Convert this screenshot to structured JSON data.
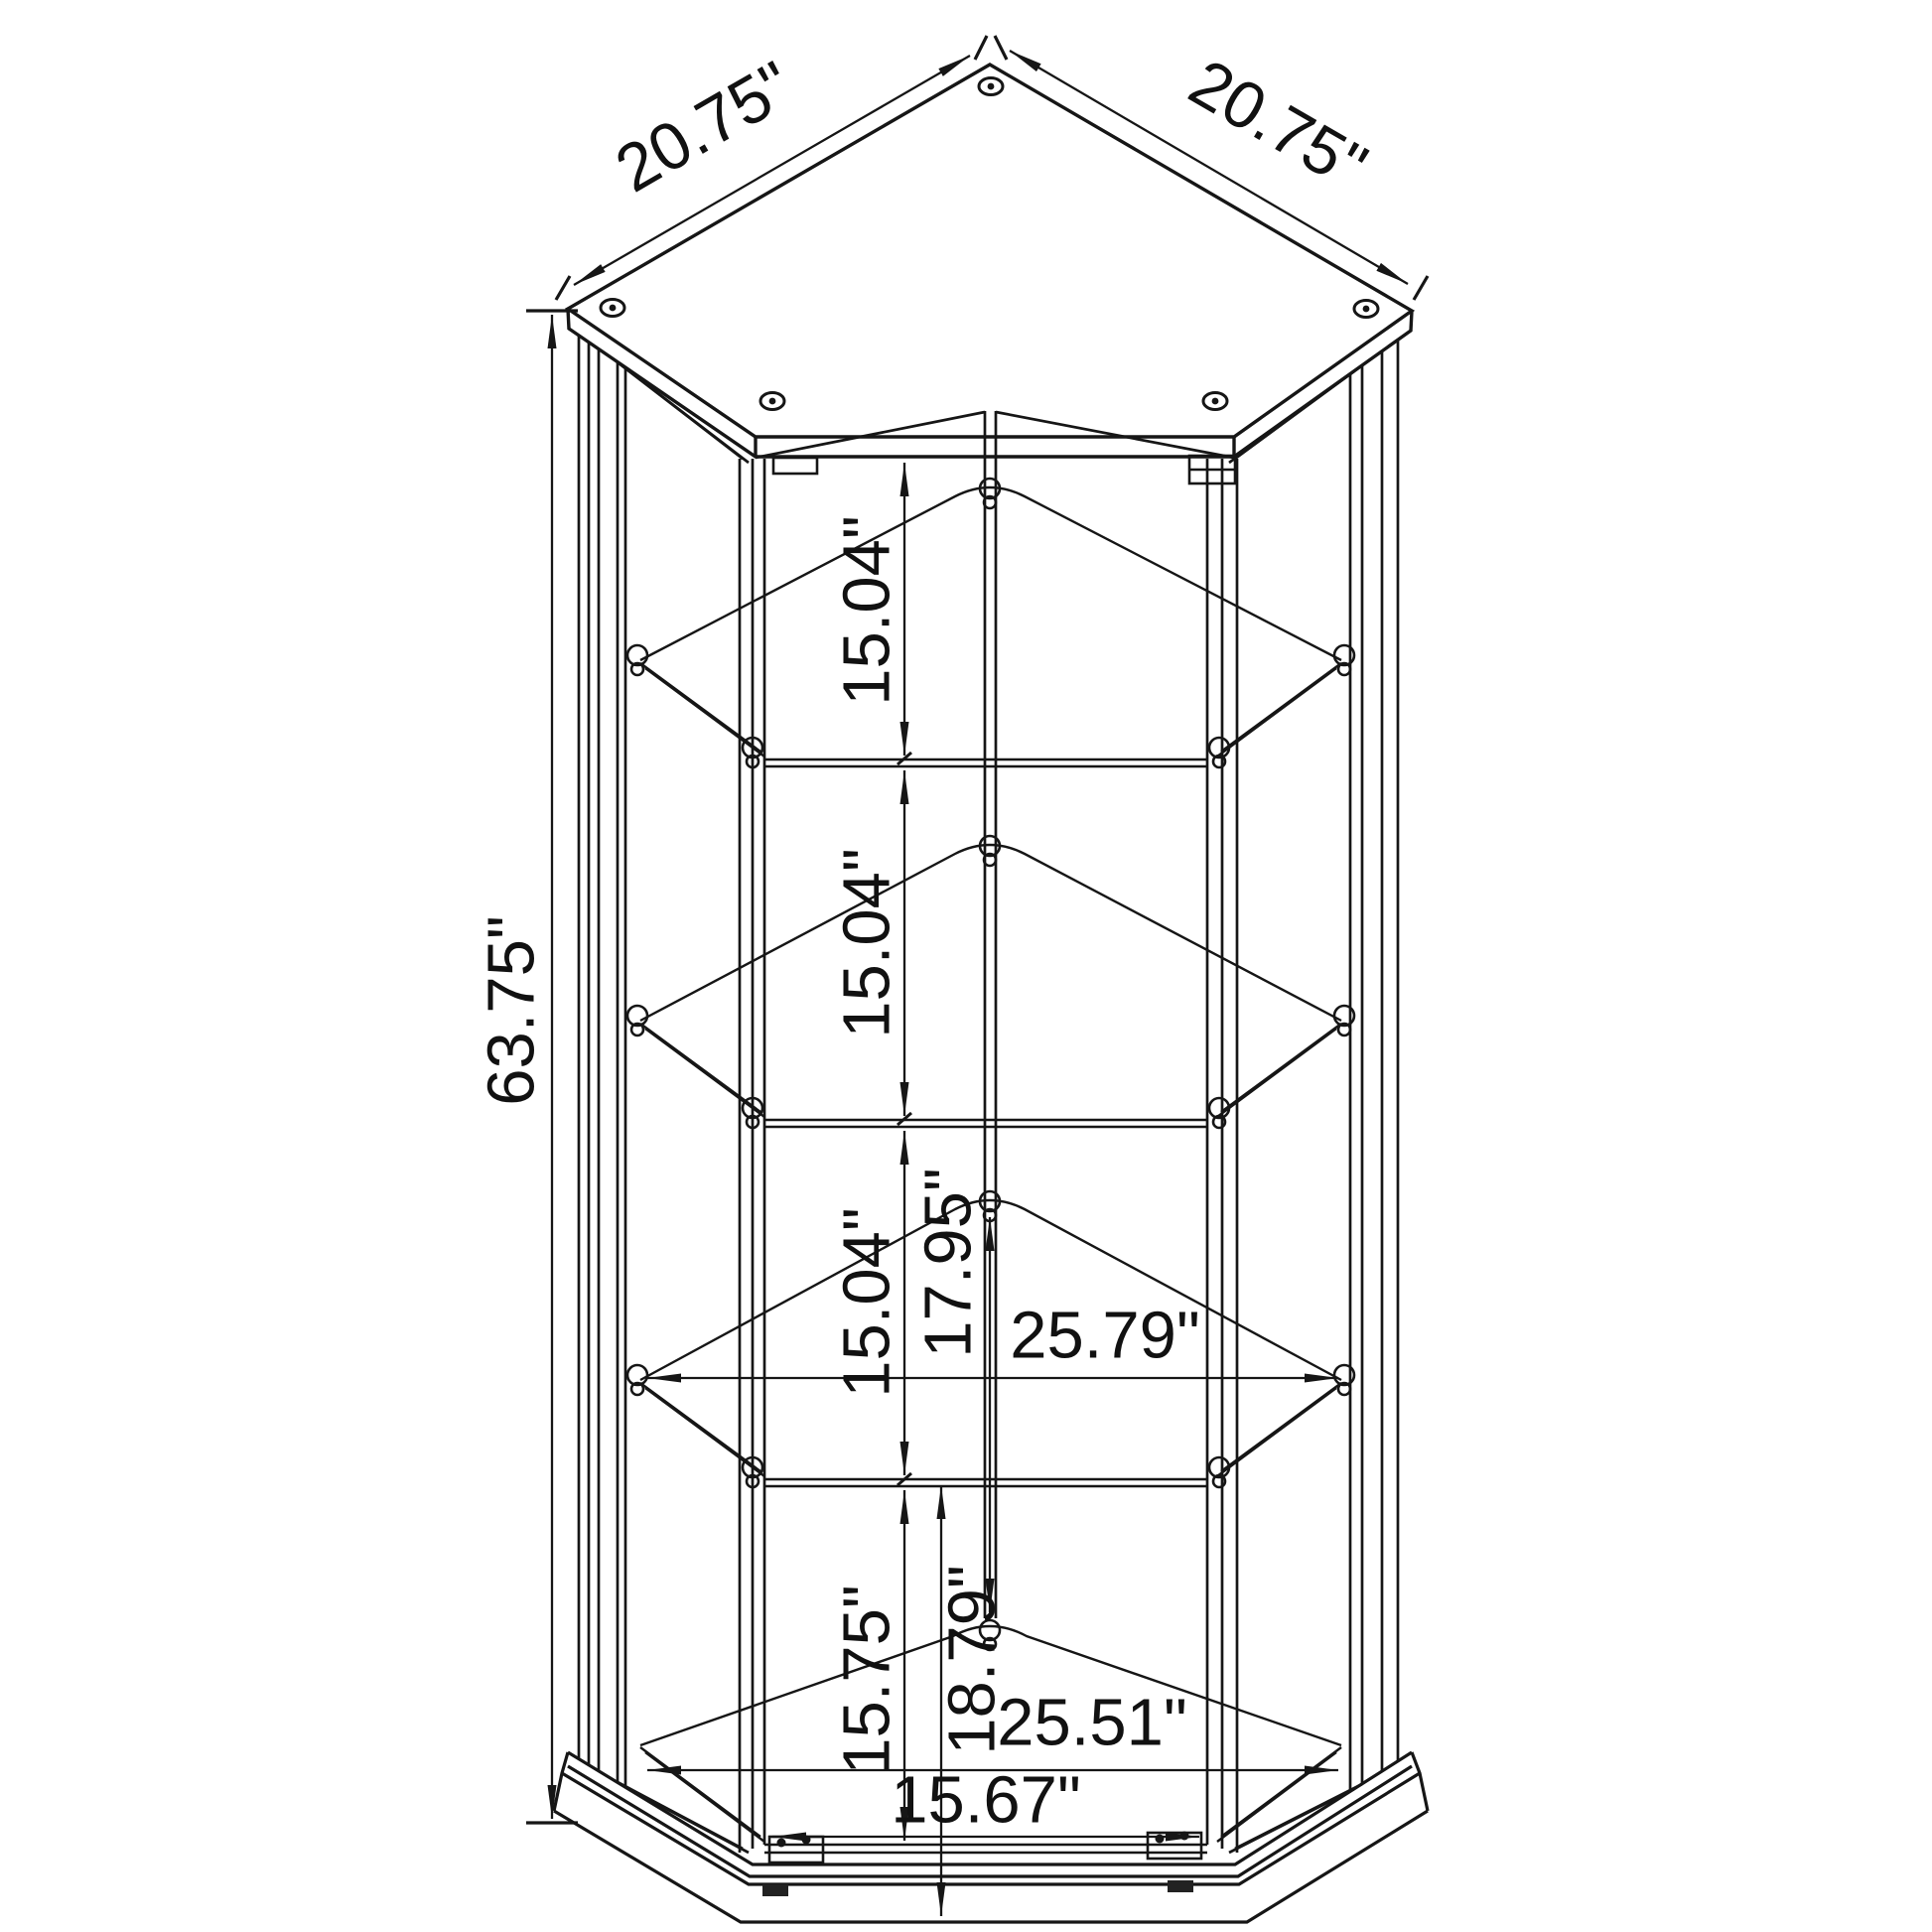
{
  "diagram": {
    "type": "furniture-dimension-line-drawing",
    "subject": "corner curio glass display cabinet with 4 shelf openings, top view of pentagonal top panel and front axonometric elevation",
    "units": "inches",
    "background_color": "#ffffff",
    "line_color": "#161616",
    "dimensions": {
      "top_edge_left": "20.75\"",
      "top_edge_right": "20.75\"",
      "overall_height": "63.75\"",
      "shelf_spacing_1": "15.04\"",
      "shelf_spacing_2": "15.04\"",
      "shelf_spacing_3": "15.04\"",
      "back_corner_lower_section": "17.95\"",
      "width_at_shelf_level": "25.79\"",
      "bottom_section_front_height": "15.75\"",
      "bottom_section_back_height": "18.79\"",
      "base_width": "25.51\"",
      "door_opening_width": "15.67\""
    }
  }
}
